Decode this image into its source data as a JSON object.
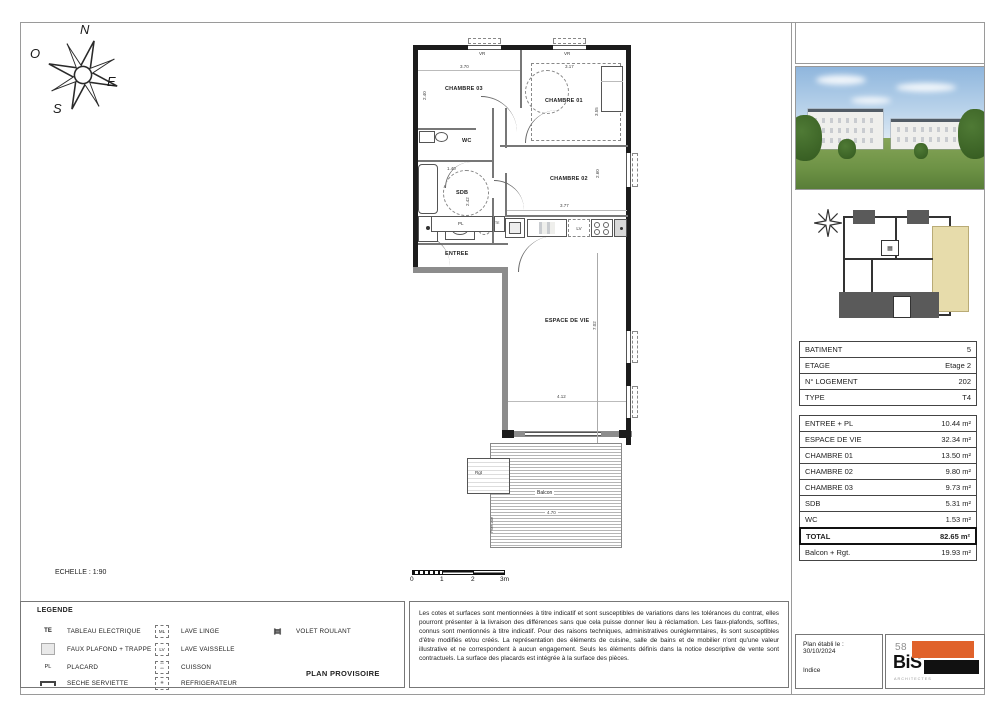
{
  "sheet": {
    "scale_label": "ECHELLE : 1:90",
    "scale_ticks": [
      "0",
      "1",
      "2",
      "3m"
    ]
  },
  "compass": {
    "north": "N",
    "west": "O",
    "east": "E",
    "south": "S"
  },
  "plan": {
    "rooms": {
      "chambre03": "CHAMBRE 03",
      "chambre01": "CHAMBRE 01",
      "chambre02": "CHAMBRE 02",
      "wc": "WC",
      "sdb": "SDB",
      "entree": "ENTREE",
      "espace_de_vie": "ESPACE DE VIE",
      "balcon": "Balcon",
      "rgt": "Rgt",
      "pare_vue": "Pare-vue"
    },
    "tags": {
      "pl": "PL",
      "te": "TE",
      "lv": "LV",
      "ml": "ML",
      "vr": "VR"
    },
    "dims": {
      "chambre03_w": "3.70",
      "chambre03_h": "2.40",
      "chambre01_w": "3.17",
      "chambre01_h": "3.55",
      "sdb_w": "1.40",
      "sdb_h": "2.42",
      "chambre02_w": "3.77",
      "chambre02_h": "2.60",
      "espace_w": "4.12",
      "espace_h": "7.02",
      "balcon_w": "4.70"
    }
  },
  "info_table": {
    "rows": [
      {
        "label": "BATIMENT",
        "value": "5"
      },
      {
        "label": "ETAGE",
        "value": "Etage 2"
      },
      {
        "label": "N° LOGEMENT",
        "value": "202"
      },
      {
        "label": "TYPE",
        "value": "T4"
      }
    ],
    "surfaces": [
      {
        "label": "ENTREE + PL",
        "value": "10.44 m²"
      },
      {
        "label": "ESPACE DE VIE",
        "value": "32.34 m²"
      },
      {
        "label": "CHAMBRE 01",
        "value": "13.50 m²"
      },
      {
        "label": "CHAMBRE 02",
        "value": "9.80 m²"
      },
      {
        "label": "CHAMBRE 03",
        "value": "9.73 m²"
      },
      {
        "label": "SDB",
        "value": "5.31 m²"
      },
      {
        "label": "WC",
        "value": "1.53 m²"
      }
    ],
    "total": {
      "label": "TOTAL",
      "value": "82.65 m²"
    },
    "balcony": {
      "label": "Balcon + Rgt.",
      "value": "19.93 m²"
    }
  },
  "legend": {
    "title": "LEGENDE",
    "col1": [
      {
        "symbol": "TE",
        "label": "TABLEAU ELECTRIQUE"
      },
      {
        "symbol": "",
        "label": "FAUX PLAFOND + TRAPPE"
      },
      {
        "symbol": "PL",
        "label": "PLACARD"
      },
      {
        "symbol": "",
        "label": "SECHE SERVIETTE"
      }
    ],
    "col2": [
      {
        "symbol": "ML",
        "label": "LAVE LINGE"
      },
      {
        "symbol": "LV",
        "label": "LAVE VAISSELLE"
      },
      {
        "symbol": "",
        "label": "CUISSON"
      },
      {
        "symbol": "",
        "label": "REFRIGERATEUR"
      }
    ],
    "col3": [
      {
        "symbol": "VR",
        "label": "VOLET ROULANT"
      }
    ],
    "footer": "PLAN PROVISOIRE"
  },
  "disclaimer": "Les cotes et surfaces sont mentionnées à titre indicatif et sont susceptibles de variations dans les tolérances du contrat, elles pourront présenter à la livraison des différences sans que cela puisse donner lieu à réclamation. Les faux-plafonds, soffites, connus sont mentionnés à titre indicatif. Pour des raisons techniques, administratives ouréglemntaires, ils sont susceptibles d'être modifiés et/ou créés. La représentation des éléments de cuisine, salle de bains et de mobilier n'ont qu'une valeur illustrative et ne correspondent à aucun engagement. Seuls les éléments définis dans la notice descriptive de vente sont contractuels. La surface des placards est intégrée à la surface des pièces.",
  "titleblock": {
    "date_label": "Plan établi le :",
    "date": "30/10/2024",
    "indice_label": "Indice",
    "logo_number": "58",
    "logo_name": "BiS",
    "logo_sub": "ARCHITECTES",
    "logo_orange": "#e0622b"
  }
}
